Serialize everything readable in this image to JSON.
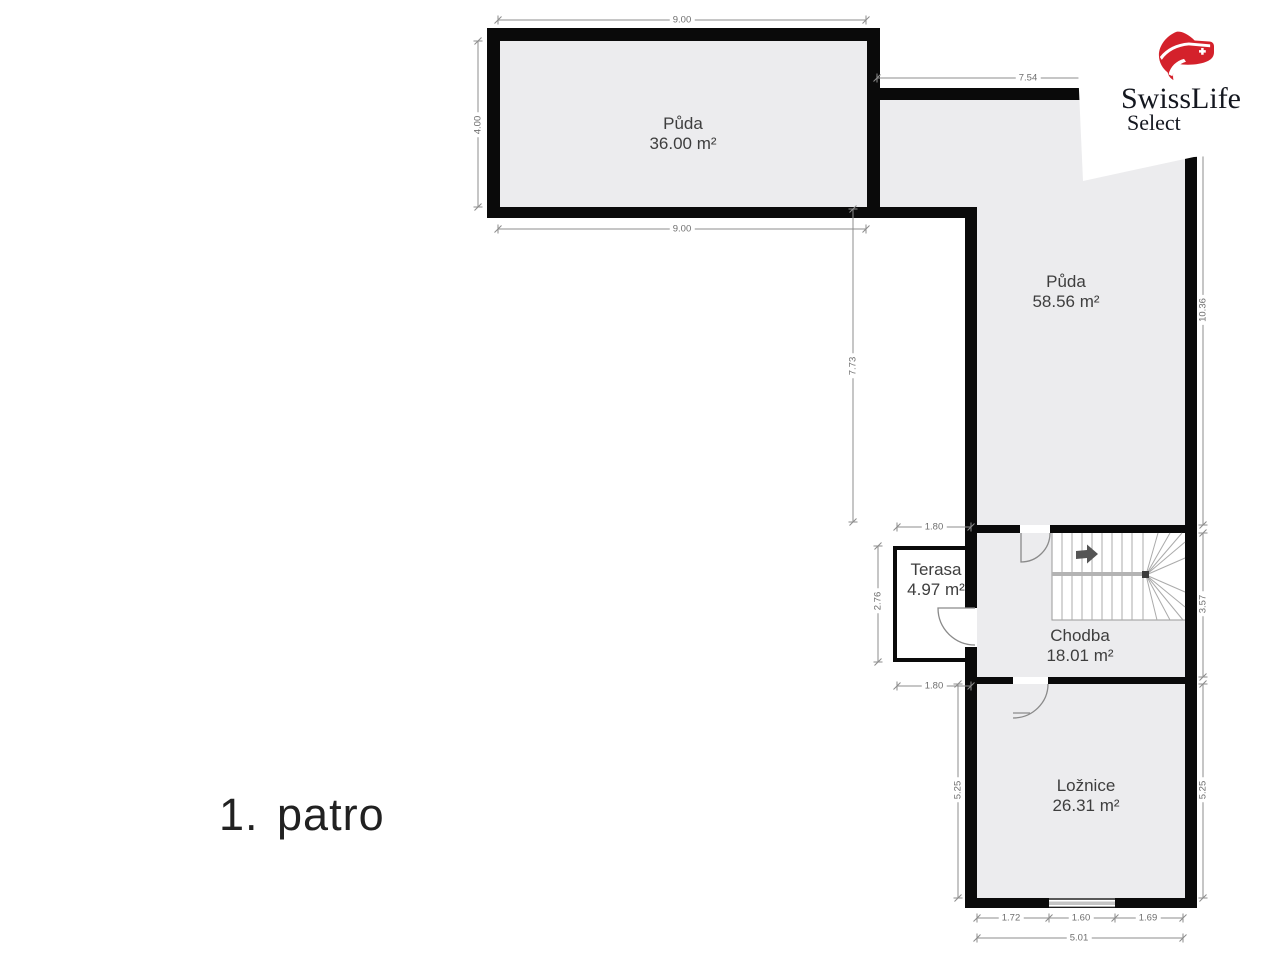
{
  "floor": {
    "label": "1. patro"
  },
  "logo": {
    "brand": "SwissLife",
    "product": "Select",
    "red": "#d4212b"
  },
  "rooms": {
    "attic_small": {
      "name": "Půda",
      "area": "36.00 m²"
    },
    "attic_large": {
      "name": "Půda",
      "area": "58.56 m²"
    },
    "terrace": {
      "name": "Terasa",
      "area": "4.97 m²"
    },
    "hallway": {
      "name": "Chodba",
      "area": "18.01 m²"
    },
    "bedroom": {
      "name": "Ložnice",
      "area": "26.31 m²"
    }
  },
  "dimensions": {
    "attic_small_width_top": "9.00",
    "attic_small_width_bottom": "9.00",
    "attic_small_height": "4.00",
    "attic_large_width": "7.54",
    "attic_large_height_left": "7.73",
    "attic_large_height_right": "10.36",
    "terrace_width_top": "1.80",
    "terrace_width_bottom": "1.80",
    "terrace_height": "2.76",
    "hallway_height": "3.57",
    "bedroom_height_left": "5.25",
    "bedroom_height_right": "5.25",
    "bedroom_segment_left": "1.72",
    "bedroom_window_width": "1.60",
    "bedroom_segment_right": "1.69",
    "bedroom_width_total": "5.01"
  },
  "colors": {
    "wall": "#0a0a0a",
    "floor_fill": "#ececee",
    "dimension": "#8c8c8c"
  }
}
